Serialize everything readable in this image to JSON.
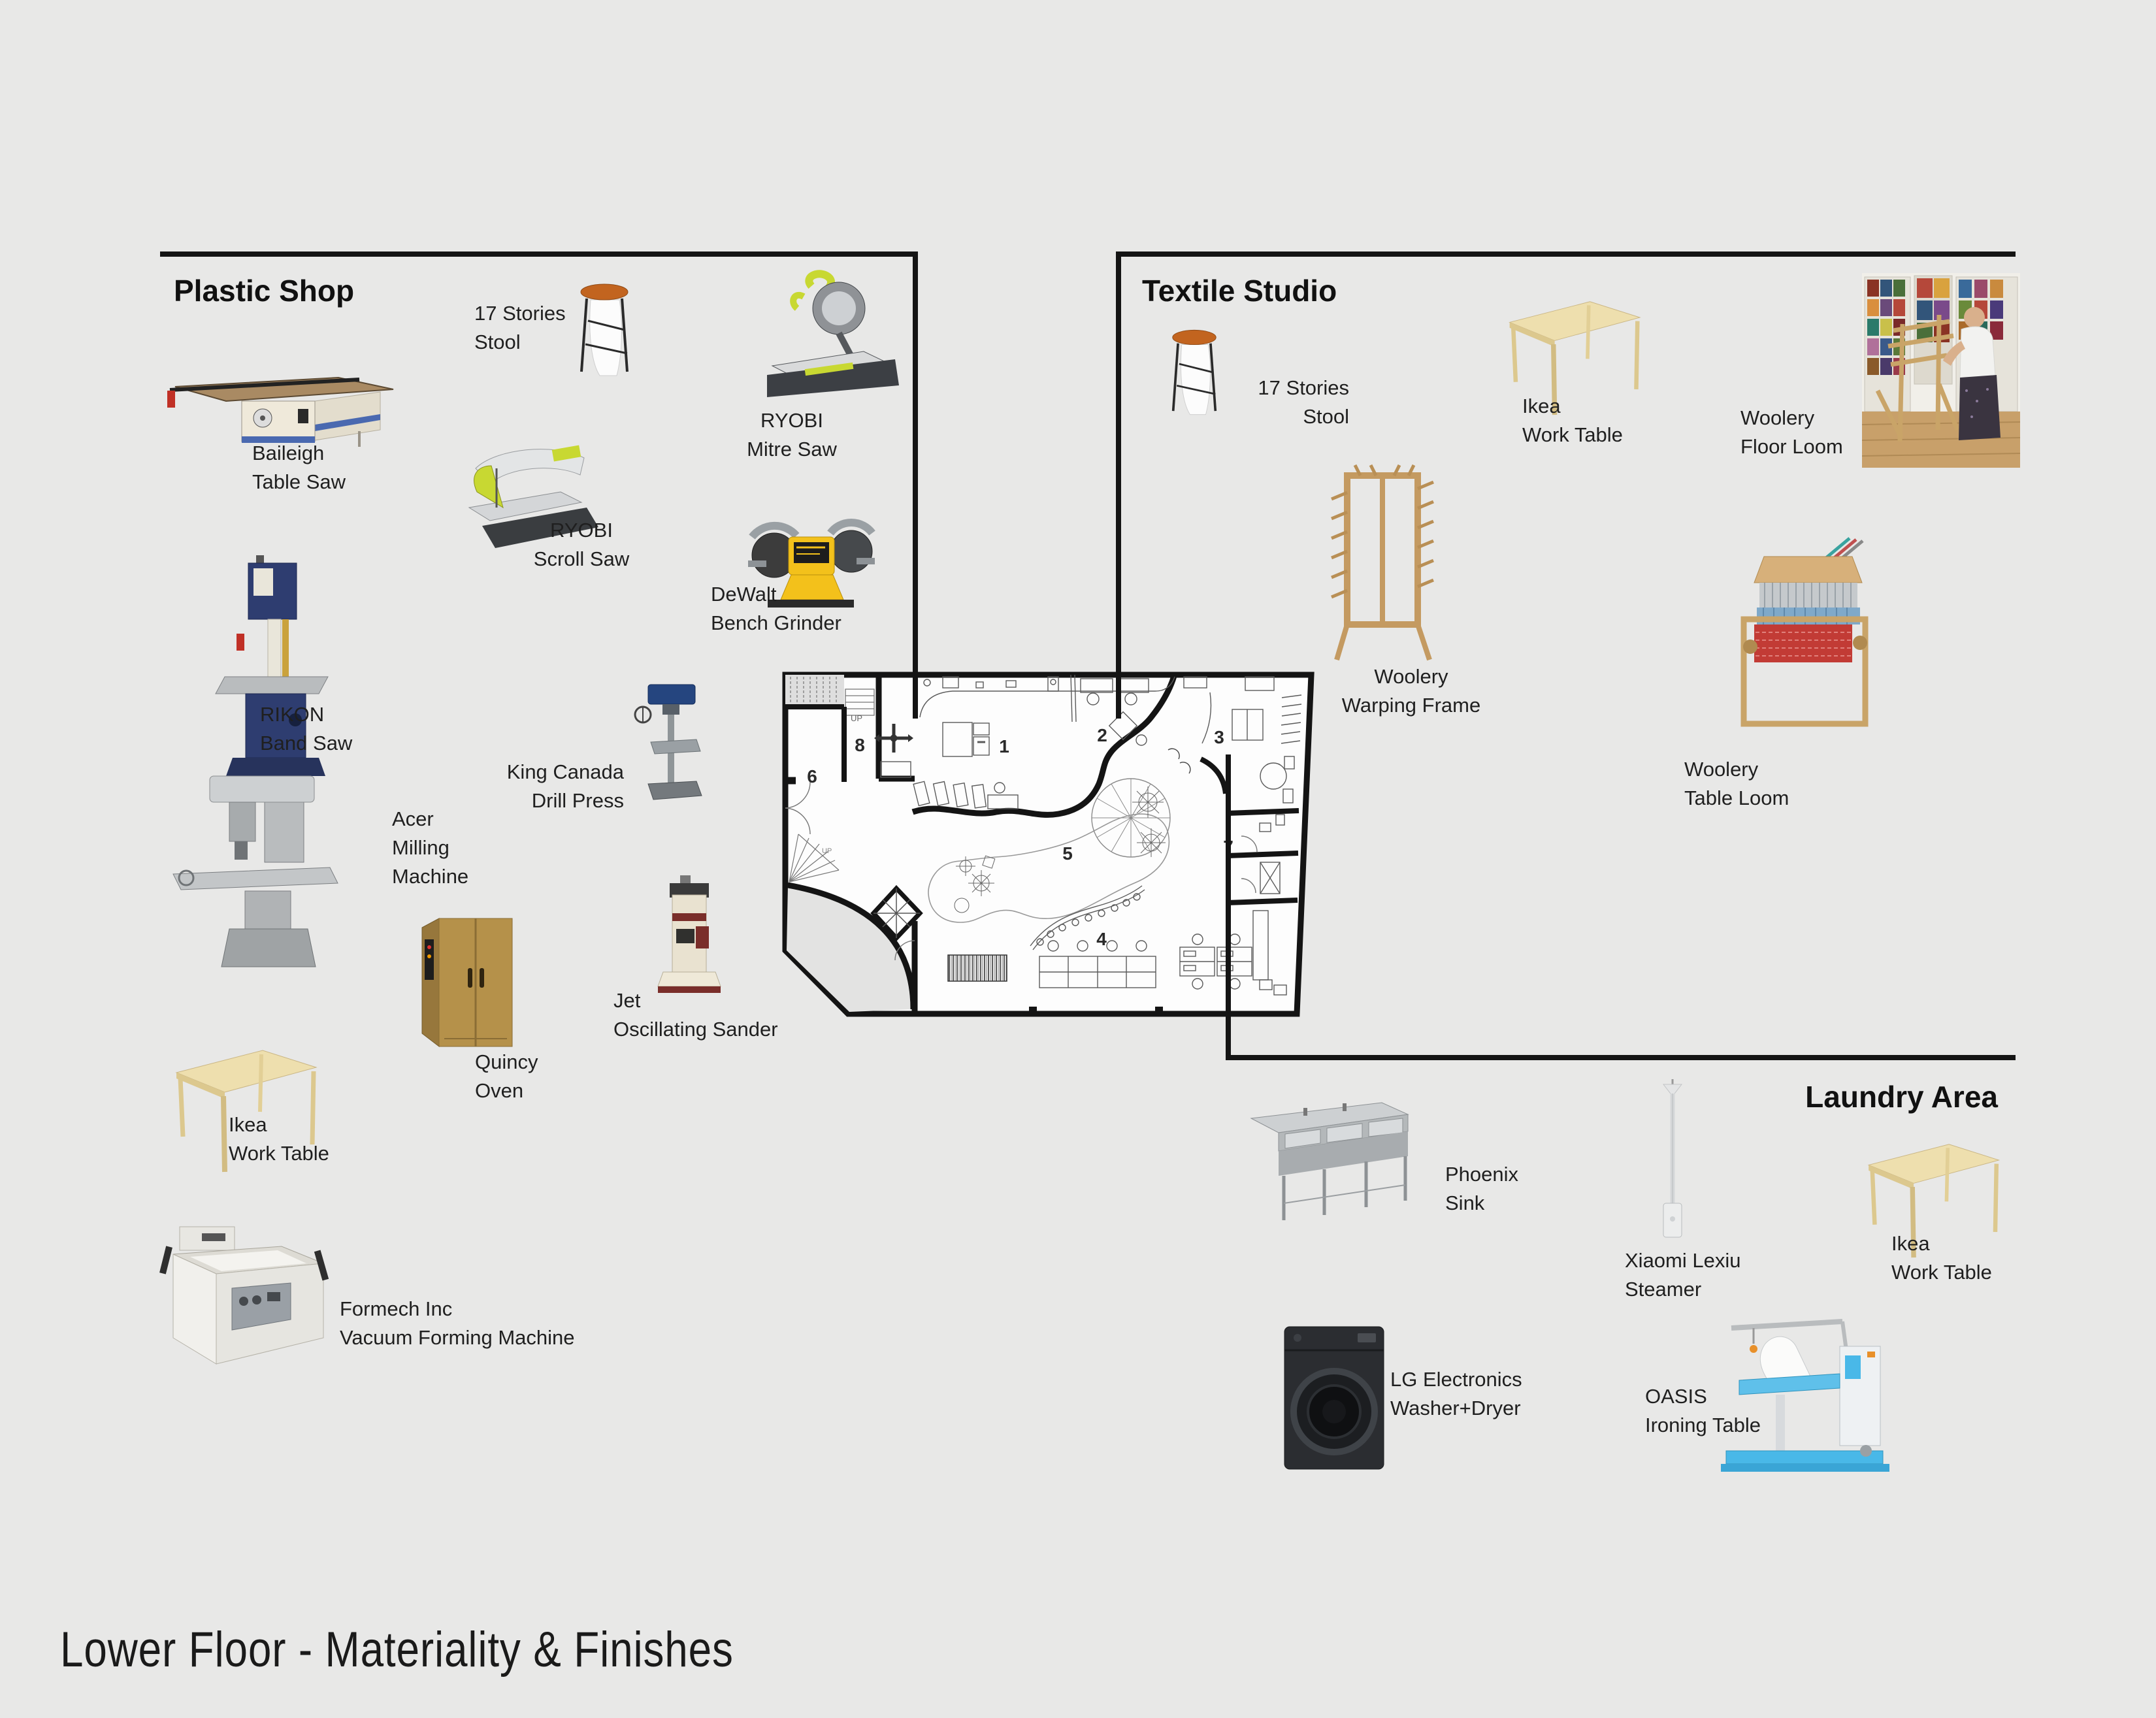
{
  "page": {
    "title": "Lower Floor - Materiality & Finishes",
    "background": "#e8e8e7"
  },
  "plastic_shop": {
    "title": "Plastic Shop",
    "items": {
      "table_saw": {
        "l1": "Baileigh",
        "l2": "Table Saw"
      },
      "stool": {
        "l1": "17 Stories",
        "l2": "Stool"
      },
      "mitre_saw": {
        "l1": "RYOBI",
        "l2": "Mitre Saw"
      },
      "scroll_saw": {
        "l1": "RYOBI",
        "l2": "Scroll Saw"
      },
      "bench_grinder": {
        "l1": "DeWalt",
        "l2": "Bench Grinder"
      },
      "band_saw": {
        "l1": "RIKON",
        "l2": "Band Saw"
      },
      "milling": {
        "l1": "Acer",
        "l2": "Milling",
        "l3": "Machine"
      },
      "drill_press": {
        "l1": "King Canada",
        "l2": "Drill Press"
      },
      "oven": {
        "l1": "Quincy",
        "l2": "Oven"
      },
      "sander": {
        "l1": "Jet",
        "l2": "Oscillating Sander"
      },
      "work_table": {
        "l1": "Ikea",
        "l2": "Work Table"
      },
      "vacuum_former": {
        "l1": "Formech Inc",
        "l2": "Vacuum Forming Machine"
      }
    }
  },
  "textile_studio": {
    "title": "Textile Studio",
    "items": {
      "stool": {
        "l1": "17 Stories",
        "l2": "Stool"
      },
      "work_table": {
        "l1": "Ikea",
        "l2": "Work Table"
      },
      "floor_loom": {
        "l1": "Woolery",
        "l2": "Floor Loom"
      },
      "warping_frame": {
        "l1": "Woolery",
        "l2": "Warping Frame"
      },
      "table_loom": {
        "l1": "Woolery",
        "l2": "Table Loom"
      }
    }
  },
  "laundry_area": {
    "title": "Laundry Area",
    "items": {
      "sink": {
        "l1": "Phoenix",
        "l2": "Sink"
      },
      "steamer": {
        "l1": "Xiaomi Lexiu",
        "l2": "Steamer"
      },
      "work_table": {
        "l1": "Ikea",
        "l2": "Work Table"
      },
      "washer_dryer": {
        "l1": "LG Electronics",
        "l2": "Washer+Dryer"
      },
      "ironing_table": {
        "l1": "OASIS",
        "l2": "Ironing Table"
      }
    }
  },
  "floor_plan": {
    "rooms": [
      "1",
      "2",
      "3",
      "4",
      "5",
      "6",
      "7",
      "8"
    ],
    "up_label": "UP"
  },
  "colors": {
    "background": "#e8e8e7",
    "line": "#141414",
    "label_text": "#1f1f1f",
    "ryobi_green": "#c8d832",
    "dewalt_yellow": "#f3c11b",
    "rikon_navy": "#2e3d70",
    "birch_wood": "#eedfae",
    "oven_tan": "#b5914a",
    "stool_seat_orange": "#c2641f",
    "oasis_blue": "#49b8e8",
    "lg_black": "#2b2d31",
    "stainless_grey": "#c3c6c8",
    "loom_wood": "#c9a468",
    "sander_maroon": "#7a2e2a",
    "baileigh_cream": "#efe9da",
    "drill_press_blue": "#25457f"
  }
}
